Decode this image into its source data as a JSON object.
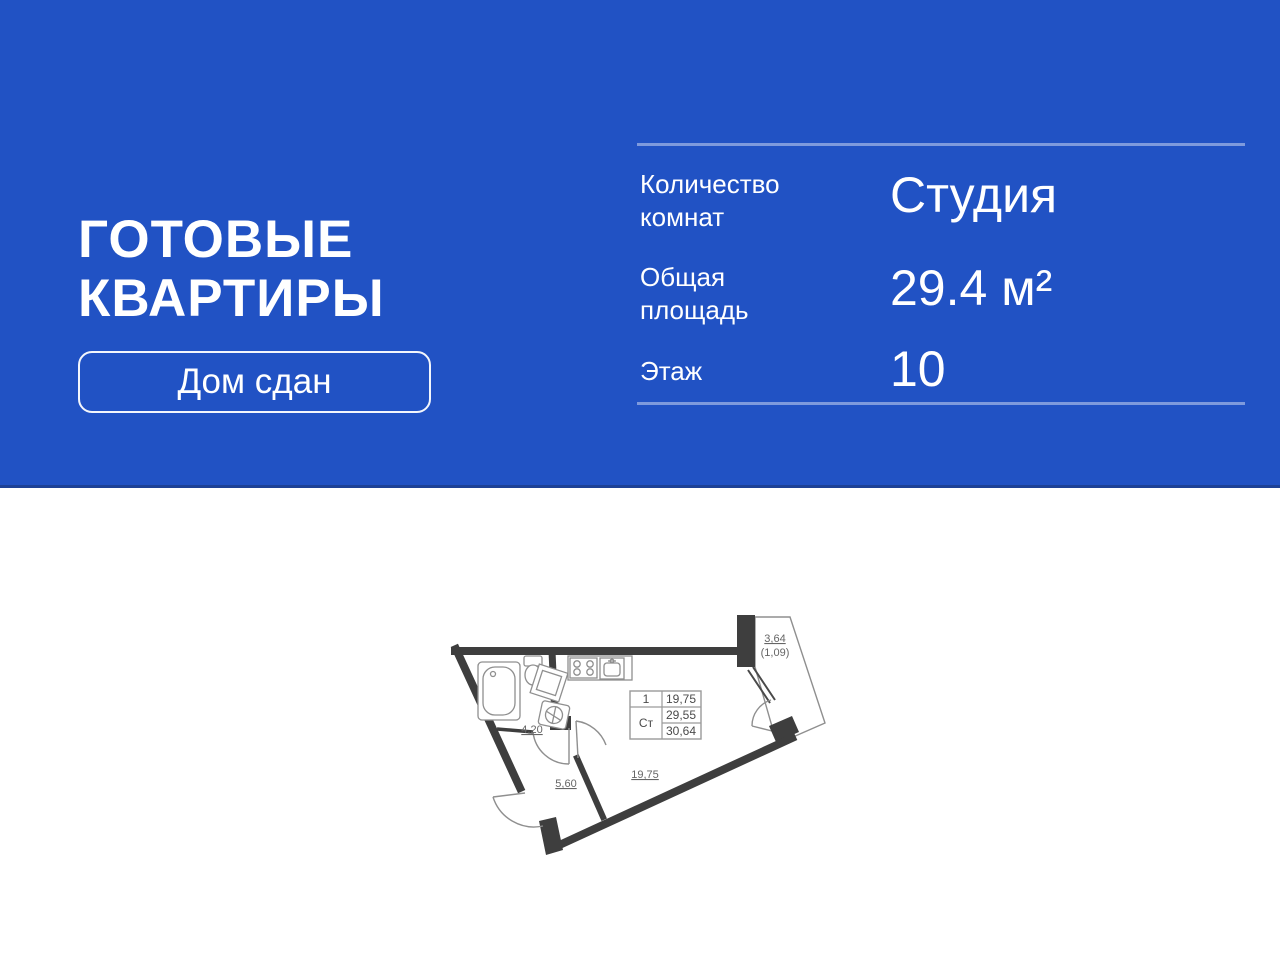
{
  "colors": {
    "banner-blue": "#2152C4",
    "wall-dark": "#3E3E3E"
  },
  "banner": {
    "title_lines": [
      "ГОТОВЫЕ",
      "КВАРТИРЫ"
    ],
    "badge_label": "Дом сдан",
    "specs": [
      {
        "label": "Количество комнат",
        "value": "Студия"
      },
      {
        "label": "Общая площадь",
        "value": "29.4 м²"
      },
      {
        "label": "Этаж",
        "value": "10"
      }
    ]
  },
  "floor_plan": {
    "areas": {
      "bathroom": "4,20",
      "hallway": "5,60",
      "living_room": "19,75",
      "balcony": "3,64",
      "balcony_reduced": "(1,09)"
    },
    "info_table": {
      "rooms_count": "1",
      "unit_type": "Ст",
      "living_area": "19,75",
      "area_no_balcony": "29,55",
      "area_total": "30,64"
    }
  }
}
